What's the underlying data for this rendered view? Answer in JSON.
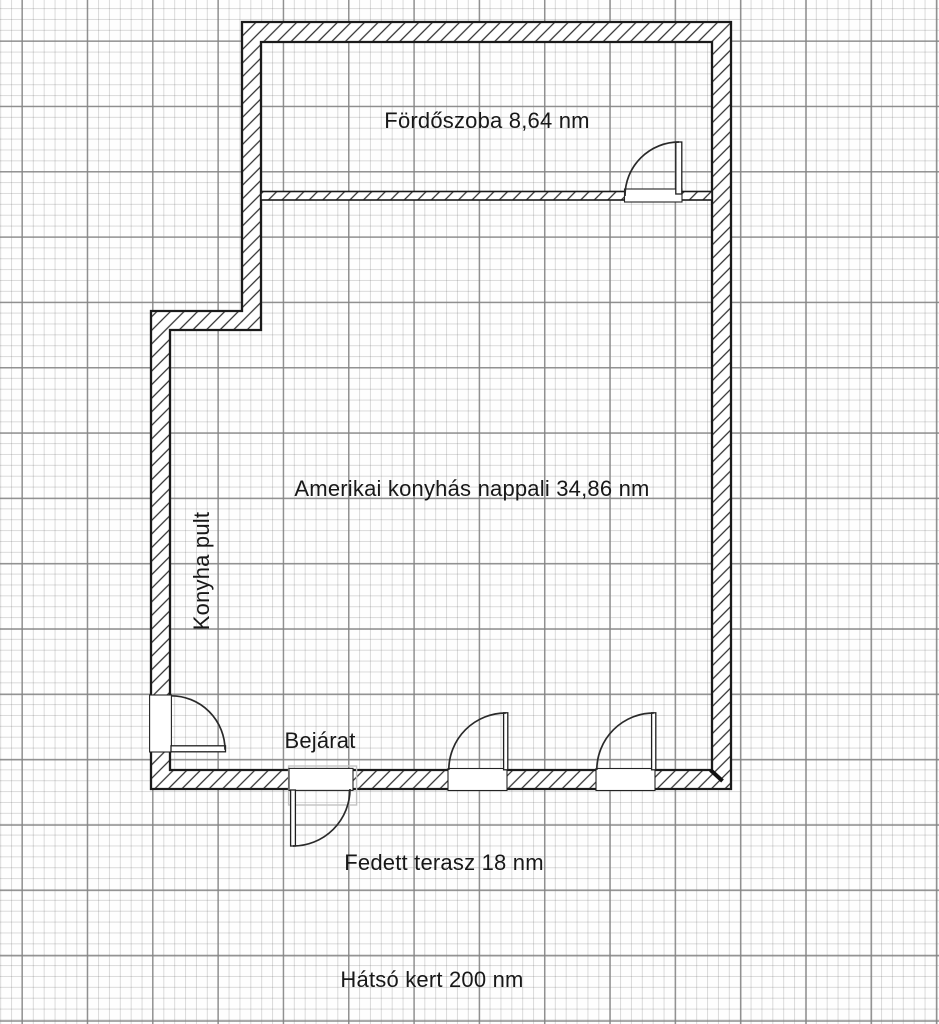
{
  "page": {
    "type": "floor-plan-drawing",
    "background": "graph-paper"
  },
  "labels": {
    "bathroom": "Fördőszoba 8,64 nm",
    "living_room": "Amerikai konyhás nappali 34,86 nm",
    "kitchen_counter": "Konyha pult",
    "entrance": "Bejárat",
    "terrace": "Fedett terasz 18 nm",
    "garden": "Hátsó kert 200 nm"
  },
  "rooms": [
    {
      "name": "Fördőszoba",
      "area": "8,64 nm"
    },
    {
      "name": "Amerikai konyhás nappali",
      "area": "34,86 nm"
    },
    {
      "name": "Fedett terasz",
      "area": "18 nm"
    },
    {
      "name": "Hátsó kert",
      "area": "200 nm"
    }
  ],
  "features": [
    {
      "name": "Konyha pult"
    },
    {
      "name": "Bejárat"
    }
  ],
  "doors": [
    {
      "name": "bathroom-door",
      "location": "partition wall, hinge right, opens into bathroom"
    },
    {
      "name": "kitchen-side-door",
      "location": "left wall, hinge bottom, opens into living room"
    },
    {
      "name": "entrance-door",
      "location": "bottom wall, hinge left, opens to terrace"
    },
    {
      "name": "terrace-door-left",
      "location": "bottom wall, hinge right, opens into living room"
    },
    {
      "name": "terrace-door-right",
      "location": "bottom wall, hinge right, opens into living room"
    }
  ],
  "colors": {
    "paper": "#fefefe",
    "grid_minor": "#d2d2d2",
    "grid_major": "#9d9d9d",
    "wall_line": "#1a1a1a",
    "hatch_line": "#2e2e2e",
    "faint_outline": "#c2c2c2",
    "text": "#181818"
  }
}
